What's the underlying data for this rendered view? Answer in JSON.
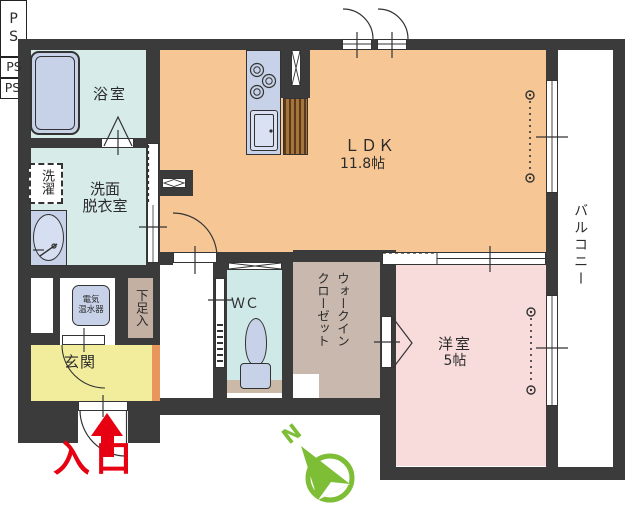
{
  "rooms": {
    "bath": "浴室",
    "washroom_line1": "洗面",
    "washroom_line2": "脱衣室",
    "laundry": "洗濯",
    "ldk": "ＬＤＫ",
    "ldk_area": "11.8帖",
    "balcony": "バルコニー",
    "western": "洋室",
    "western_area": "5帖",
    "wic_col1": "ウォークイン",
    "wic_col2": "クローゼット",
    "wc": "ＷＣ",
    "genkan": "玄関",
    "shoe": "下足入",
    "heater_line1": "電気",
    "heater_line2": "温水器"
  },
  "labels": {
    "ps1": "PS",
    "ps2": "PS",
    "ps3": "PS",
    "entrance": "入口",
    "north": "N"
  },
  "colors": {
    "wall": "#3b3b3b",
    "ldk_floor": "#f6c794",
    "western_floor": "#f8dbdb",
    "wet_room_floor": "#d7ece8",
    "wc_floor": "#cfe9e9",
    "closet_floor": "#c9b8ae",
    "shoe_floor": "#c4afa3",
    "genkan_floor": "#f2ed9d",
    "step_strip": "#e9965c",
    "fixture_blue": "#c7d2e8",
    "wood_counter": "#a5753e",
    "compass_green": "#7dbe36",
    "entrance_red": "#e60012"
  }
}
